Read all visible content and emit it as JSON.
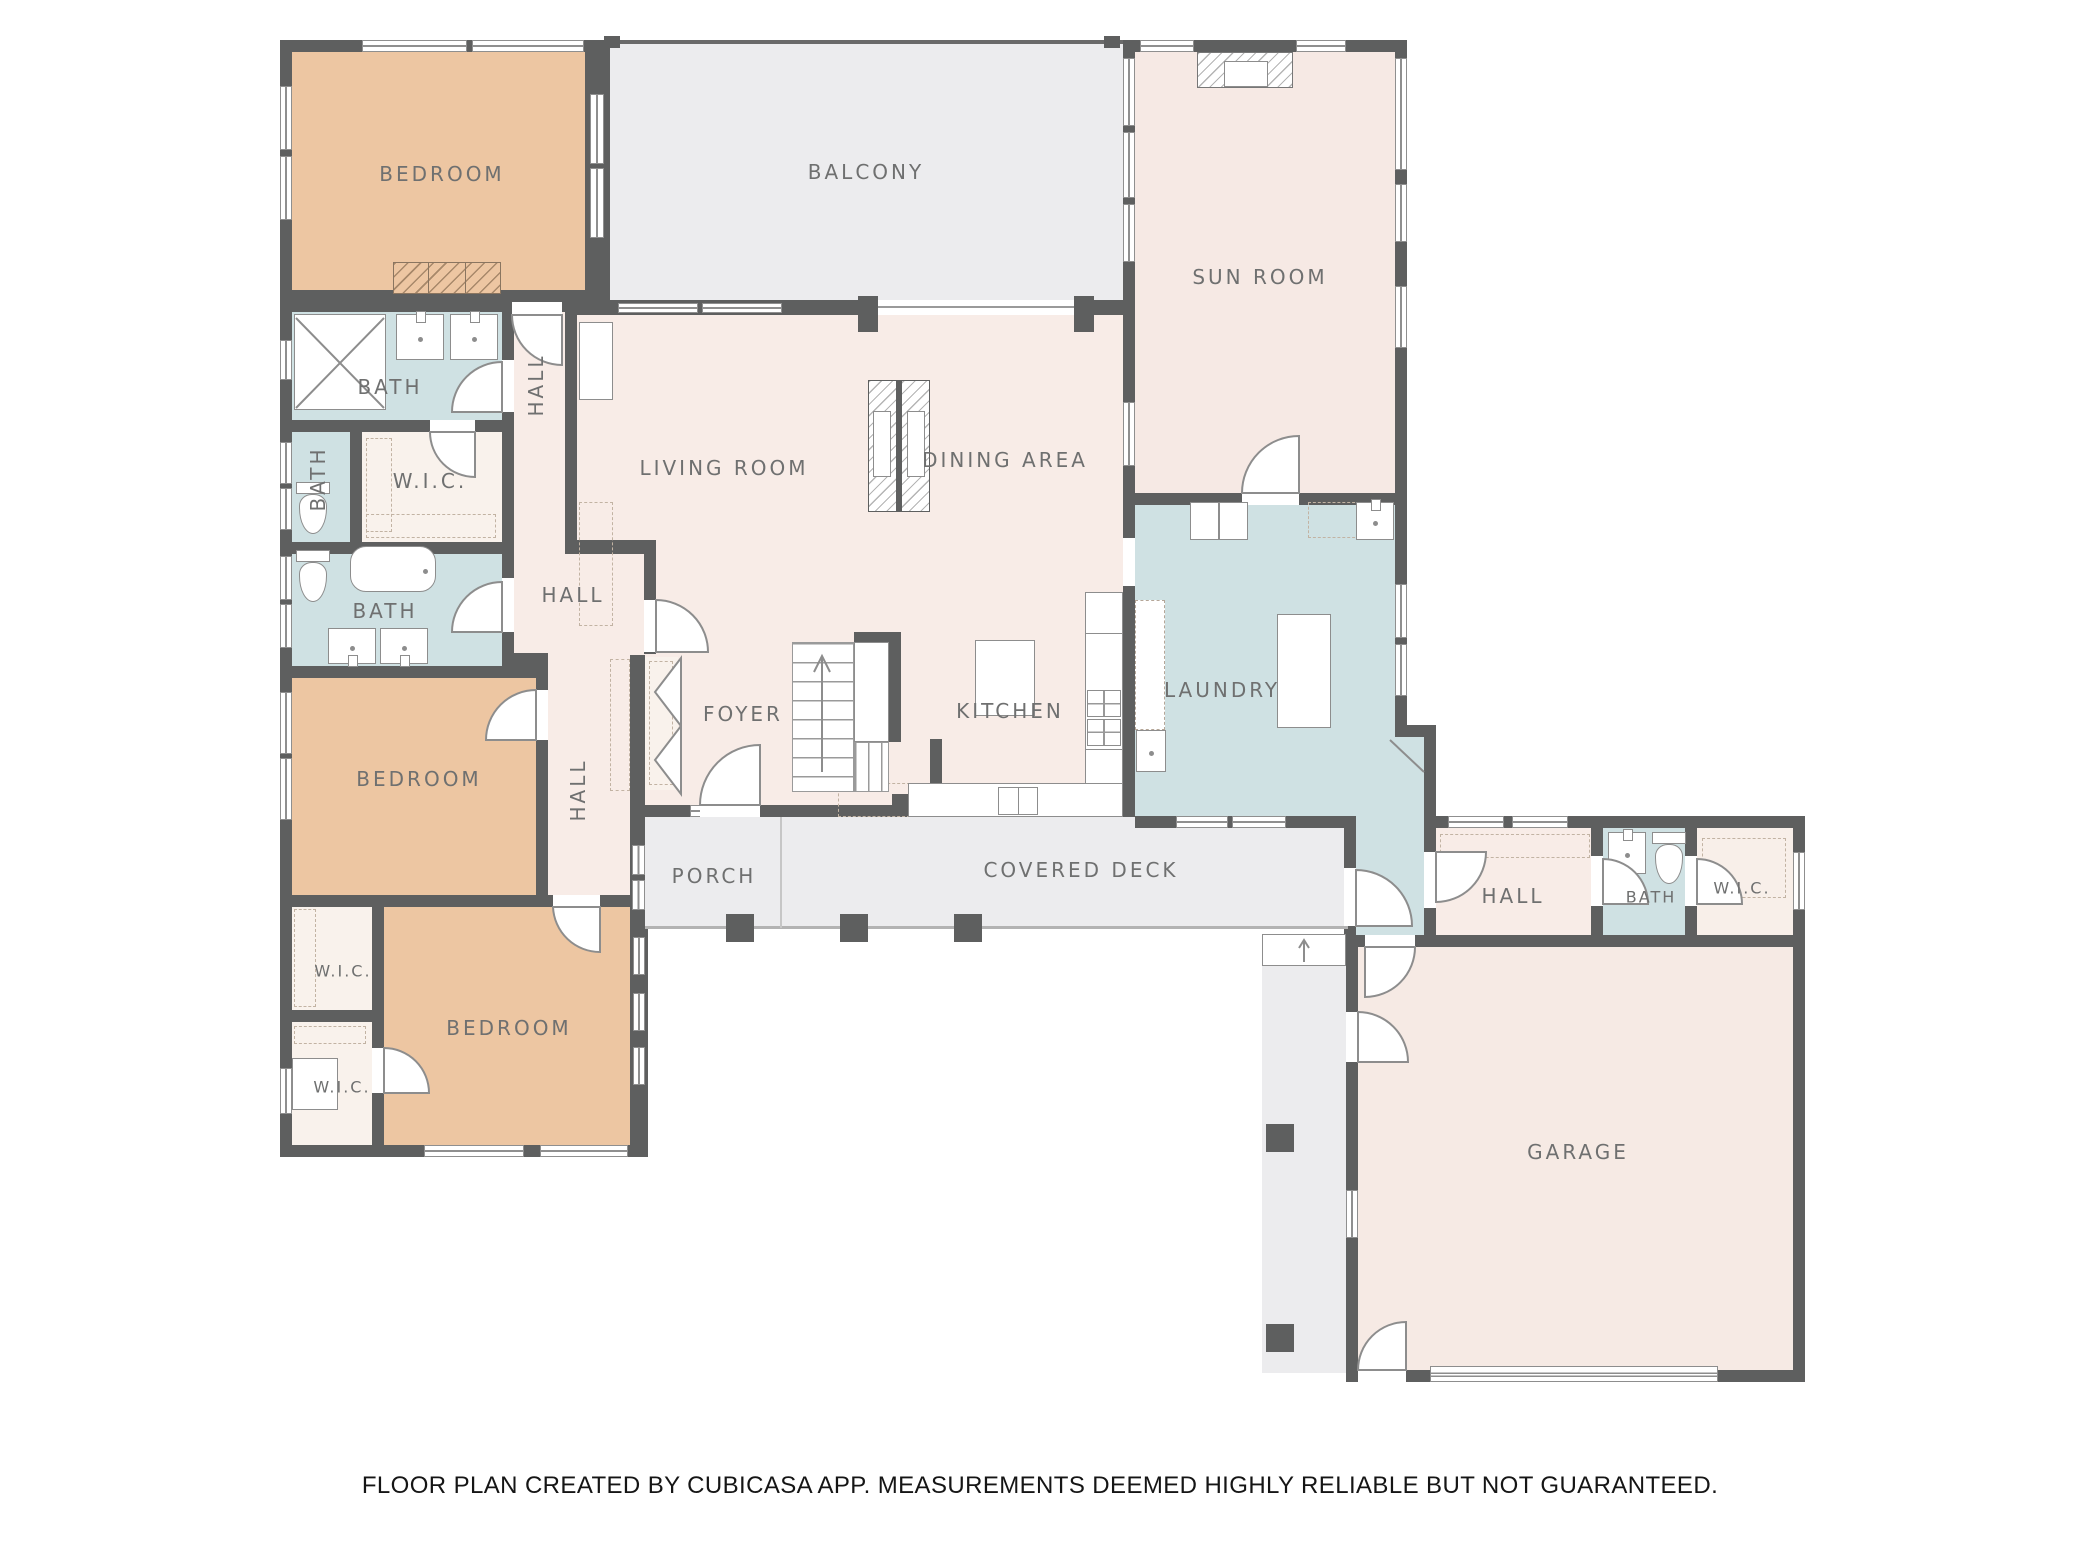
{
  "footer": {
    "disclaimer": "FLOOR PLAN CREATED BY CUBICASA APP. MEASUREMENTS DEEMED HIGHLY RELIABLE BUT NOT GUARANTEED."
  },
  "colors": {
    "wall": "#5e5f5f",
    "bedroom_fill": "#edc6a2",
    "wet_room_fill": "#cfe1e3",
    "living_fill": "#f8ece7",
    "outdoor_fill": "#ececee",
    "closet_fill": "#f9f2ec",
    "garage_fill": "#f6eae4",
    "label_text": "#6f7070"
  },
  "rooms": {
    "bedroom_top": {
      "label": "BEDROOM"
    },
    "balcony": {
      "label": "BALCONY"
    },
    "sun_room": {
      "label": "SUN ROOM"
    },
    "bath_top": {
      "label": "BATH"
    },
    "hall_upper": {
      "label": "HALL"
    },
    "wic_upper": {
      "label": "W.I.C."
    },
    "bath_left": {
      "label": "BATH"
    },
    "living_room": {
      "label": "LIVING ROOM"
    },
    "dining_area": {
      "label": "DINING AREA"
    },
    "bath_mid": {
      "label": "BATH"
    },
    "hall_mid": {
      "label": "HALL"
    },
    "laundry": {
      "label": "LAUNDRY"
    },
    "kitchen": {
      "label": "KITCHEN"
    },
    "foyer": {
      "label": "FOYER"
    },
    "hall_lower": {
      "label": "HALL"
    },
    "bedroom_mid": {
      "label": "BEDROOM"
    },
    "porch": {
      "label": "PORCH"
    },
    "covered_deck": {
      "label": "COVERED DECK"
    },
    "wic_lower_1": {
      "label": "W.I.C."
    },
    "wic_lower_2": {
      "label": "W.I.C."
    },
    "bedroom_bottom": {
      "label": "BEDROOM"
    },
    "hall_garage": {
      "label": "HALL"
    },
    "bath_garage": {
      "label": "BATH"
    },
    "wic_garage": {
      "label": "W.I.C."
    },
    "garage": {
      "label": "GARAGE"
    }
  }
}
